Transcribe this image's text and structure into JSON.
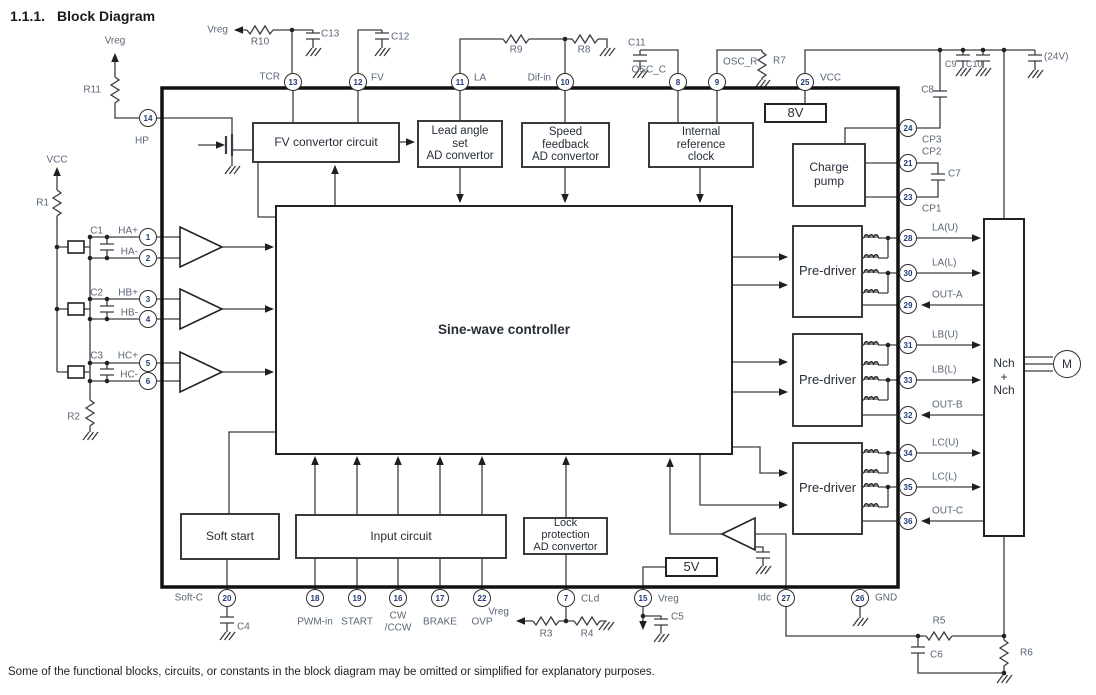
{
  "heading": {
    "number": "1.1.1.",
    "text": "Block Diagram"
  },
  "footnote": "Some of the functional blocks, circuits, or constants in the block diagram may be omitted or simplified for explanatory purposes.",
  "labels": {
    "vreg": "Vreg",
    "vcc": "VCC"
  },
  "blocks": {
    "fv": "FV convertor circuit",
    "lead_angle": [
      "Lead angle",
      "set",
      "AD convertor"
    ],
    "speed": [
      "Speed",
      "feedback",
      "AD convertor"
    ],
    "clock": [
      "Internal",
      "reference",
      "clock"
    ],
    "v8": "8V",
    "charge_pump": [
      "Charge",
      "pump"
    ],
    "sine": "Sine-wave controller",
    "pre_driver": "Pre-driver",
    "soft_start": "Soft start",
    "input": "Input circuit",
    "lock": [
      "Lock",
      "protection",
      "AD convertor"
    ],
    "v5": "5V",
    "nch": [
      "Nch",
      "+",
      "Nch"
    ],
    "motor": "M"
  },
  "pins": {
    "tcr": {
      "num": "13",
      "label": "TCR"
    },
    "fv": {
      "num": "12",
      "label": "FV"
    },
    "la": {
      "num": "11",
      "label": "LA"
    },
    "difin": {
      "num": "10",
      "label": "Dif-in"
    },
    "oscc": {
      "num": "8",
      "label": "OSC_C"
    },
    "oscr": {
      "num": "9",
      "label": "OSC_R"
    },
    "vcc": {
      "num": "25",
      "label": "VCC"
    },
    "hp": {
      "num": "14",
      "label": "HP"
    },
    "ha_p": {
      "num": "1",
      "label": "HA+"
    },
    "ha_m": {
      "num": "2",
      "label": "HA-"
    },
    "hb_p": {
      "num": "3",
      "label": "HB+"
    },
    "hb_m": {
      "num": "4",
      "label": "HB-"
    },
    "hc_p": {
      "num": "5",
      "label": "HC+"
    },
    "hc_m": {
      "num": "6",
      "label": "HC-"
    },
    "softc": {
      "num": "20",
      "label": "Soft-C"
    },
    "pwmin": {
      "num": "18",
      "label": "PWM-in"
    },
    "start": {
      "num": "19",
      "label": "START"
    },
    "cwccw": {
      "num": "16",
      "label1": "CW",
      "label2": "/CCW"
    },
    "brake": {
      "num": "17",
      "label": "BRAKE"
    },
    "ovp": {
      "num": "22",
      "label": "OVP"
    },
    "cld": {
      "num": "7",
      "label": "CLd"
    },
    "vreg15": {
      "num": "15",
      "label": "Vreg"
    },
    "idc": {
      "num": "27",
      "label": "Idc"
    },
    "gnd": {
      "num": "26",
      "label": "GND"
    },
    "cp3": {
      "num": "24",
      "label": "CP3"
    },
    "cp2": {
      "num": "21",
      "label": "CP2"
    },
    "cp1": {
      "num": "23",
      "label": "CP1"
    },
    "lau": {
      "num": "28",
      "label": "LA(U)"
    },
    "lal": {
      "num": "30",
      "label": "LA(L)"
    },
    "outa": {
      "num": "29",
      "label": "OUT-A"
    },
    "lbu": {
      "num": "31",
      "label": "LB(U)"
    },
    "lbl2": {
      "num": "33",
      "label": "LB(L)"
    },
    "outb": {
      "num": "32",
      "label": "OUT-B"
    },
    "lcu": {
      "num": "34",
      "label": "LC(U)"
    },
    "lcl": {
      "num": "35",
      "label": "LC(L)"
    },
    "outc": {
      "num": "36",
      "label": "OUT-C"
    }
  },
  "components": {
    "r1": "R1",
    "r2": "R2",
    "r3": "R3",
    "r4": "R4",
    "r5": "R5",
    "r6": "R6",
    "r7": "R7",
    "r8": "R8",
    "r9": "R9",
    "r10": "R10",
    "r11": "R11",
    "c1": "C1",
    "c2": "C2",
    "c3": "C3",
    "c4": "C4",
    "c5": "C5",
    "c6": "C6",
    "c7": "C7",
    "c8": "C8",
    "c9": "C9",
    "c10": "C10",
    "c11": "C11",
    "c12": "C12",
    "c13": "C13",
    "c_24v": "(24V)"
  }
}
